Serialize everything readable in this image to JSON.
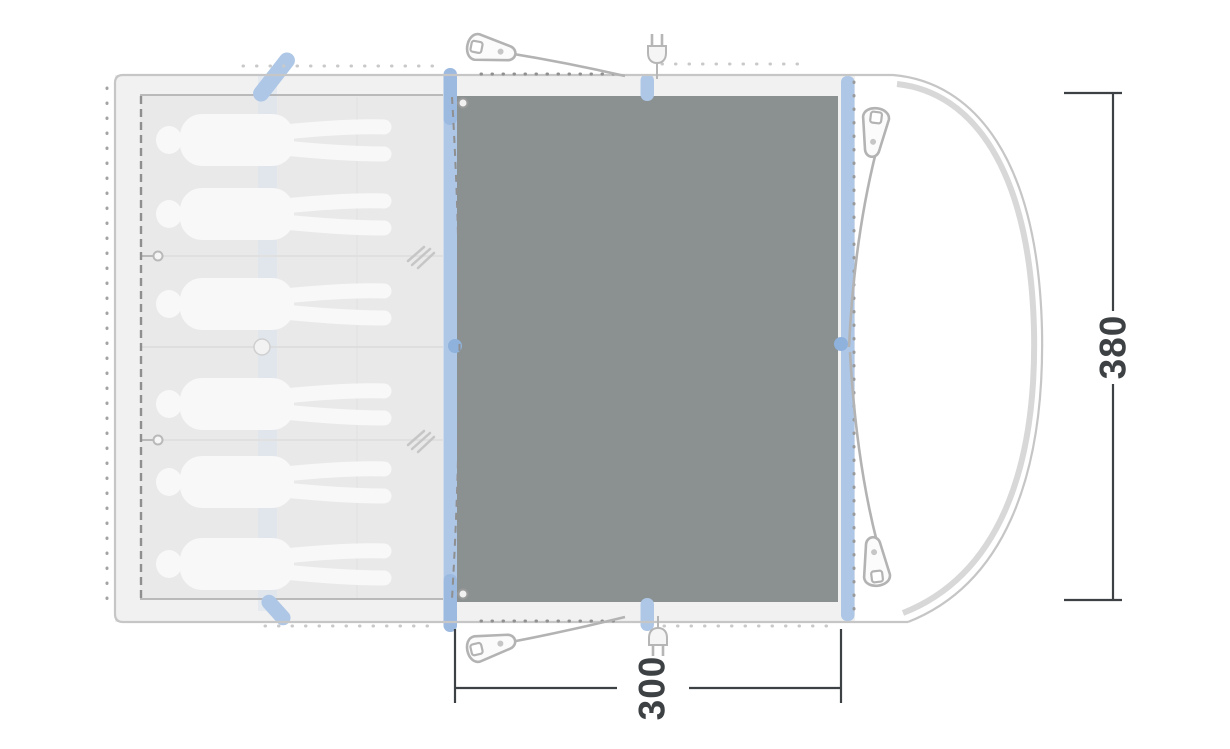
{
  "page": {
    "type": "tent-floorplan-diagram",
    "background": "#ffffff"
  },
  "dimensions": {
    "depth": {
      "value": "380",
      "orientation": "vertical-right"
    },
    "width": {
      "value": "300",
      "orientation": "horizontal-bottom"
    }
  },
  "floorplan": {
    "sleeping_cabin": {
      "sleeper_count": 6,
      "compartment_divider_count": 2,
      "sleeper_orientation": "lying-horizontal-heads-left"
    },
    "living_area": {
      "groundsheet": "dark-gray-panel"
    },
    "porch": {
      "shape": "curved-front-right"
    },
    "peg_count": 4,
    "power_inlet_count": 2,
    "pole_strip_count": 2
  },
  "icons": {
    "peg": "tent-peg-icon",
    "power": "power-plug-icon",
    "zip": "zipper-pull-icon",
    "curtain": "curtain-tieback-icon"
  },
  "colors": {
    "groundsheet": "#8b9191",
    "pole_blue": "#aec7e6",
    "pole_blue_dark": "#9cb9e0",
    "pole_bump_blue": "#8fb2dd",
    "body_gray": "#f1f1f1",
    "cabin_gray": "#e9e9e9",
    "outline_gray": "#c6c6c6",
    "thick_curve_gray": "#d8d8d8",
    "dash_gray": "#8f8f8f",
    "dot_dark": "#909090",
    "dot_light": "#c9c9c9",
    "hardware_gray": "#b3b3b3",
    "dimension_ink": "#3d4143",
    "sleeper_white": "#f8f8f8"
  }
}
